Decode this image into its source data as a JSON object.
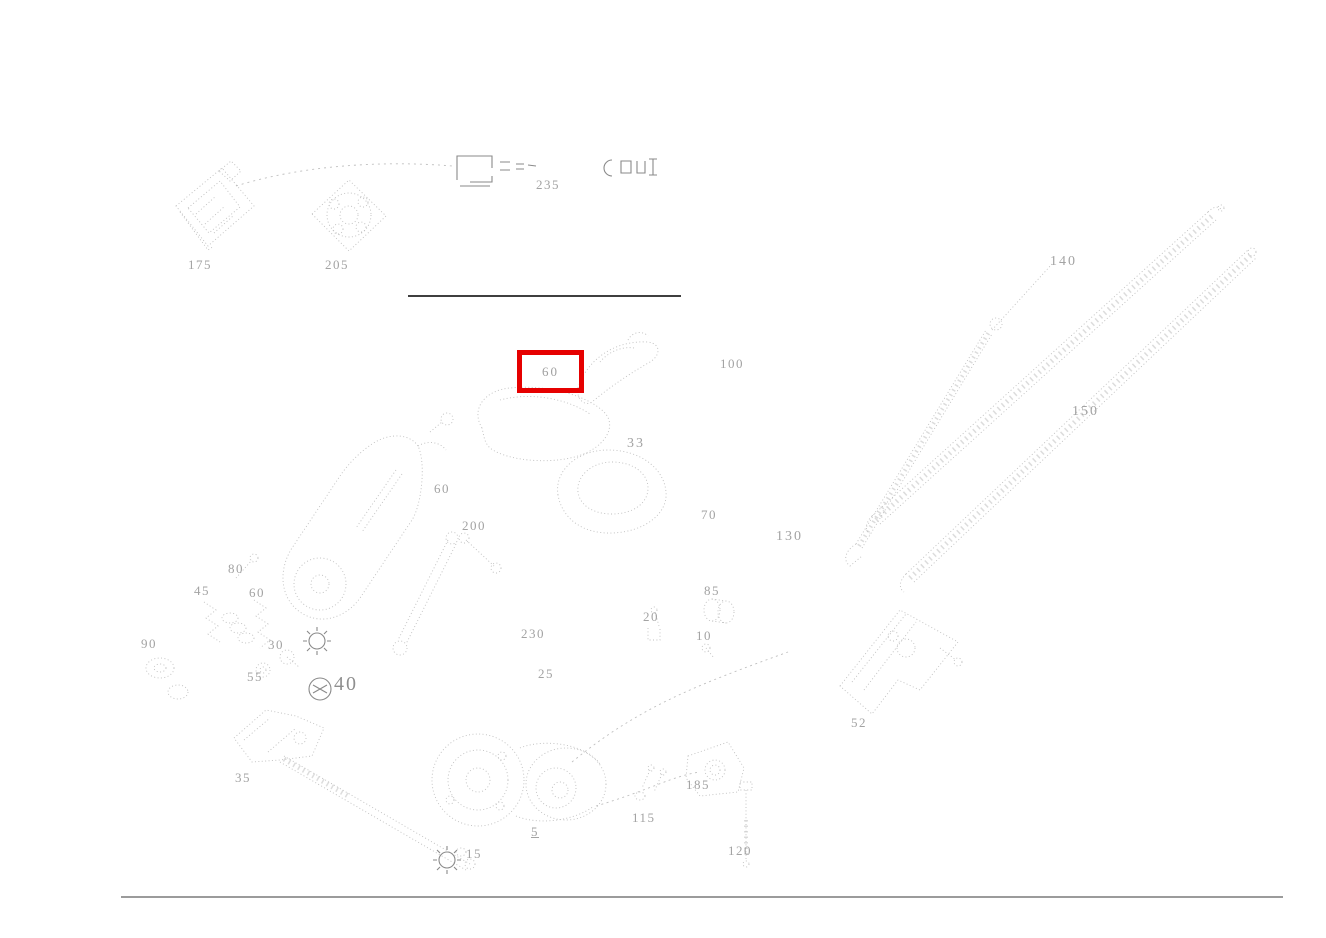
{
  "diagram": {
    "title": "wiper-system-exploded-parts-diagram",
    "highlight": {
      "label": "60",
      "color": "#e60000",
      "x": 517,
      "y": 350,
      "w": 57,
      "h": 33
    },
    "callouts": [
      {
        "label": "175",
        "x": 188,
        "y": 257
      },
      {
        "label": "205",
        "x": 325,
        "y": 257
      },
      {
        "label": "235",
        "x": 536,
        "y": 177
      },
      {
        "label": "140",
        "x": 1050,
        "y": 254,
        "cls": "md"
      },
      {
        "label": "150",
        "x": 1072,
        "y": 404,
        "cls": "md"
      },
      {
        "label": "100",
        "x": 720,
        "y": 356
      },
      {
        "label": "33",
        "x": 627,
        "y": 436,
        "cls": "md"
      },
      {
        "label": "60",
        "x": 434,
        "y": 481
      },
      {
        "label": "200",
        "x": 462,
        "y": 518
      },
      {
        "label": "70",
        "x": 701,
        "y": 507
      },
      {
        "label": "130",
        "x": 776,
        "y": 529,
        "cls": "md"
      },
      {
        "label": "80",
        "x": 228,
        "y": 561
      },
      {
        "label": "45",
        "x": 194,
        "y": 583
      },
      {
        "label": "60",
        "x": 249,
        "y": 585
      },
      {
        "label": "90",
        "x": 141,
        "y": 636
      },
      {
        "label": "30",
        "x": 268,
        "y": 637
      },
      {
        "label": "55",
        "x": 247,
        "y": 669
      },
      {
        "label": "40",
        "x": 334,
        "y": 673,
        "cls": "lg"
      },
      {
        "label": "230",
        "x": 521,
        "y": 626
      },
      {
        "label": "25",
        "x": 538,
        "y": 666
      },
      {
        "label": "20",
        "x": 643,
        "y": 609
      },
      {
        "label": "85",
        "x": 704,
        "y": 583
      },
      {
        "label": "10",
        "x": 696,
        "y": 628
      },
      {
        "label": "52",
        "x": 851,
        "y": 715
      },
      {
        "label": "35",
        "x": 235,
        "y": 770
      },
      {
        "label": "5",
        "x": 531,
        "y": 824,
        "underline": true
      },
      {
        "label": "115",
        "x": 632,
        "y": 810
      },
      {
        "label": "185",
        "x": 686,
        "y": 777
      },
      {
        "label": "120",
        "x": 728,
        "y": 843
      },
      {
        "label": "15",
        "x": 466,
        "y": 846
      }
    ],
    "rules": {
      "top_separator": {
        "x": 408,
        "y": 295,
        "w": 273
      },
      "bottom_rule": {
        "x": 121,
        "y": 896,
        "w": 1162
      }
    }
  }
}
